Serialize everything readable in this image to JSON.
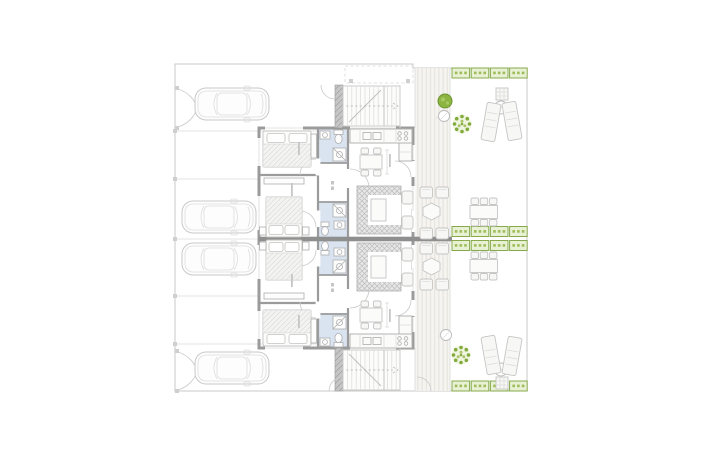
{
  "page": {
    "background": "#ffffff"
  },
  "floor_plan": {
    "kind": "architectural ground-floor plan",
    "description": "Two mirrored semi-detached dwellings with driveways and gates on the left, bedrooms and bathrooms in the middle, open-plan kitchen/living rooms, a shared timber deck strip and private gardens with planters, dining sets, sun loungers, parasols and trees on the right; external staircases at top and bottom.",
    "colors": {
      "background": "#ffffff",
      "boundary_line": "#c8c8c8",
      "light_line": "#dadada",
      "wall": "#9b9b9b",
      "wall_dark": "#8f8f8f",
      "bathroom_fill": "#dae3f0",
      "deck_fill": "#f6f4f0",
      "deck_stripe": "#e4e1da",
      "furniture_line": "#c5c5c5",
      "furniture_fill": "#f7f7f5",
      "sofa_fill": "#e7e7e7",
      "sofa_hatch": "#bcbcbc",
      "green_line": "#87a94c",
      "green_fill": "#e9f1d5",
      "green_tick": "#9dbd59",
      "tree_solid": "#8bb440",
      "tree_dot": "#82ab3d",
      "tree_halo": "#f0f5e1"
    },
    "inventory": {
      "dwelling_units": 2,
      "cars": 4,
      "driveway_gates": 2,
      "external_staircases": 2,
      "per_unit": {
        "bedrooms": 2,
        "double_beds": 2,
        "bathrooms": 2,
        "kitchens": 1,
        "indoor_dining_seats": 4,
        "sofa_sets": 1
      },
      "deck": {
        "bench_pairs": 4,
        "hex_side_tables": 2
      },
      "garden": {
        "planter_rows": 4,
        "planter_boxes_per_row": 4,
        "outdoor_dining_tables": 2,
        "outdoor_dining_seats_per_table": 6,
        "sun_lounger_pairs": 2,
        "parasols": 2,
        "green_trees": 3,
        "ground_marker_circles": 2
      }
    }
  }
}
